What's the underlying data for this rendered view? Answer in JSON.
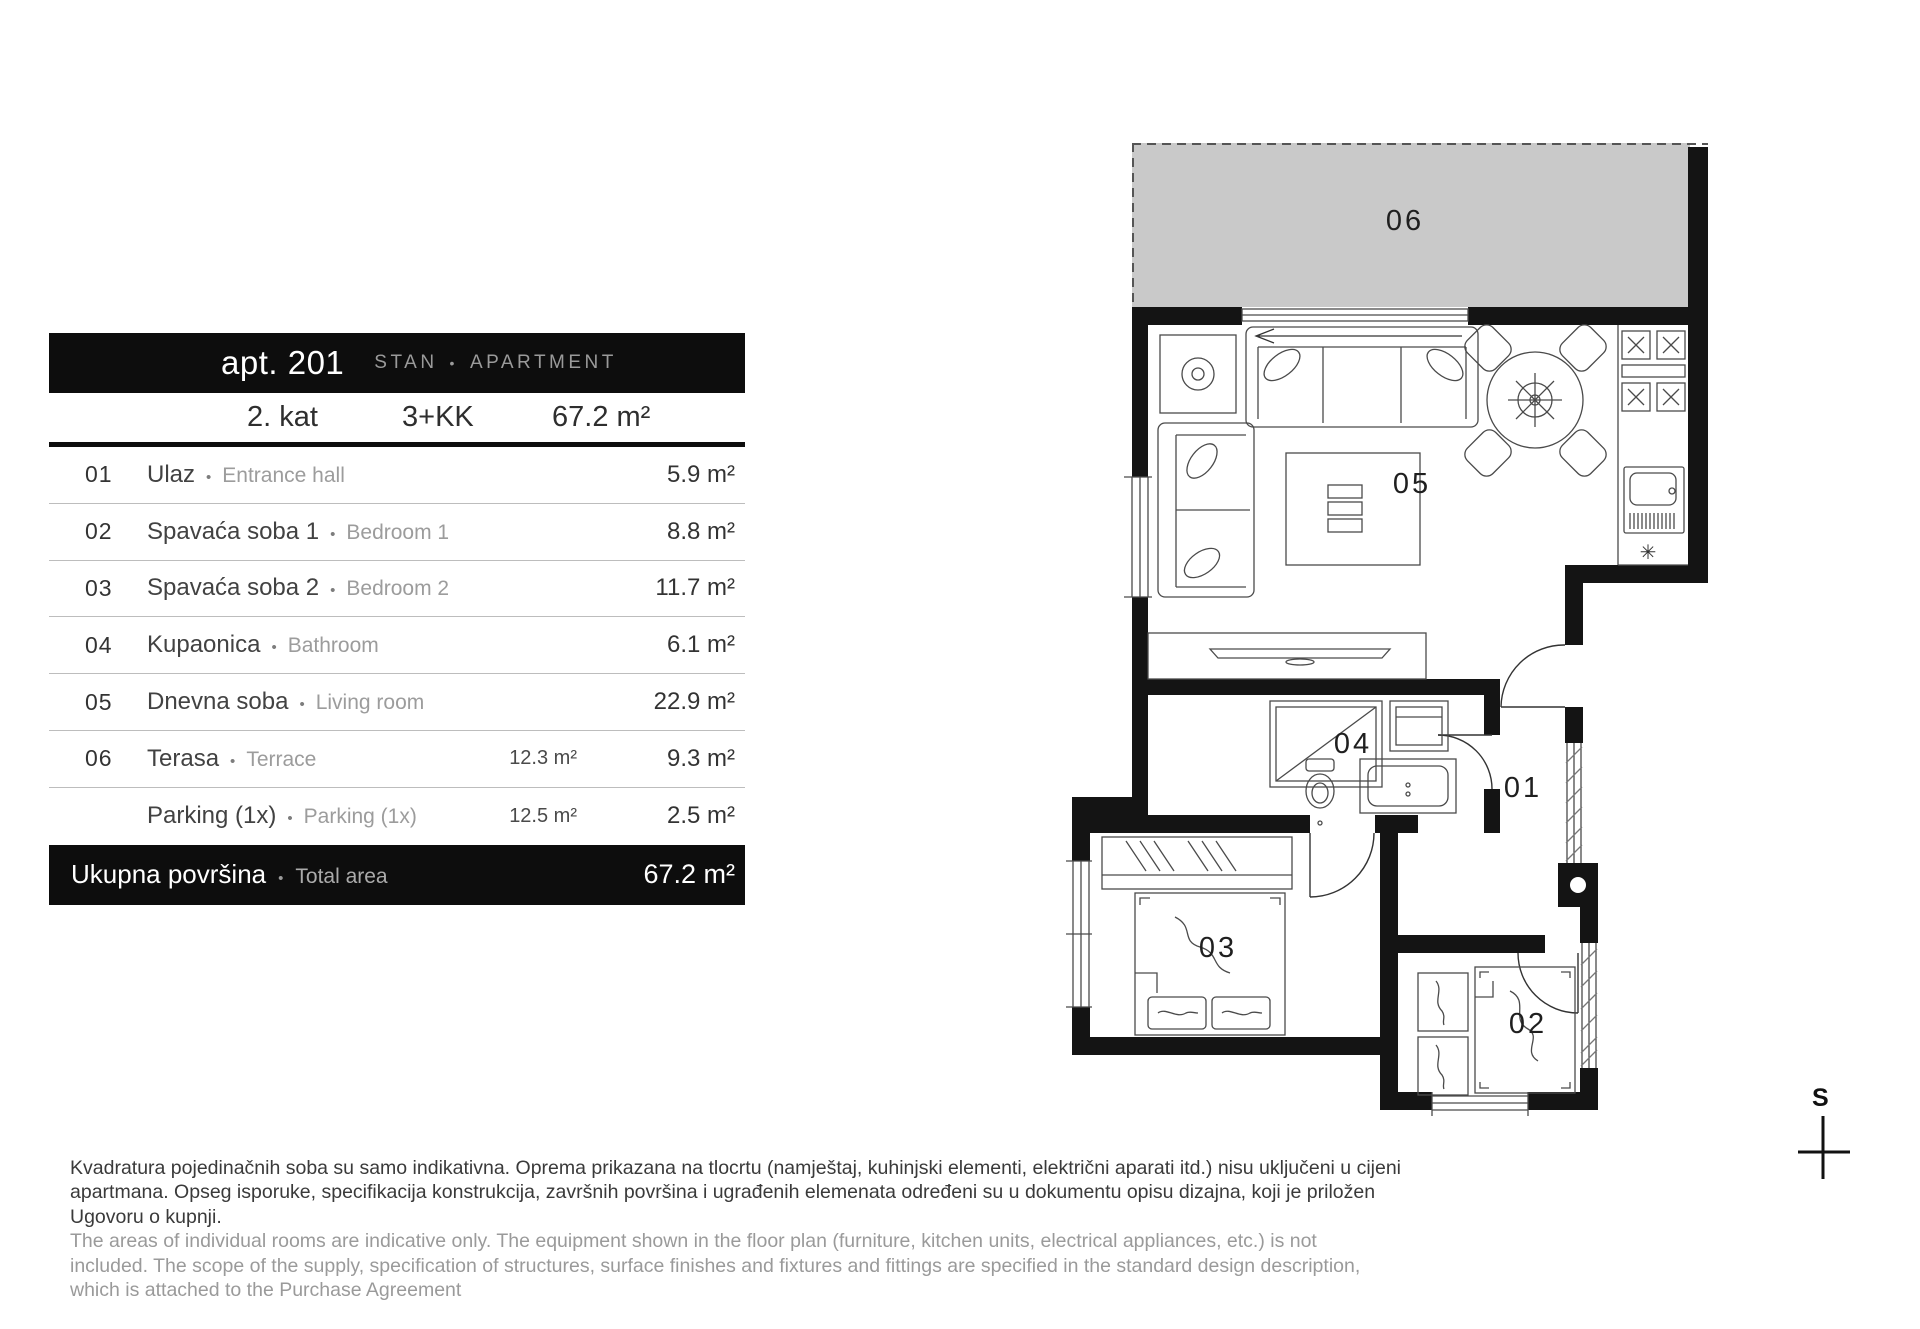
{
  "header": {
    "apt_label": "apt. 201",
    "type_hr": "STAN",
    "bullet": "•",
    "type_en": "APARTMENT",
    "floor": "2. kat",
    "layout": "3+KK",
    "total_area": "67.2 m²"
  },
  "table": {
    "rows": [
      {
        "num": "01",
        "name_hr": "Ulaz",
        "bullet": "•",
        "name_en": "Entrance hall",
        "gross": "",
        "area": "5.9 m²"
      },
      {
        "num": "02",
        "name_hr": "Spavaća soba 1",
        "bullet": "•",
        "name_en": "Bedroom 1",
        "gross": "",
        "area": "8.8 m²"
      },
      {
        "num": "03",
        "name_hr": "Spavaća soba 2",
        "bullet": "•",
        "name_en": "Bedroom 2",
        "gross": "",
        "area": "11.7 m²"
      },
      {
        "num": "04",
        "name_hr": "Kupaonica",
        "bullet": "•",
        "name_en": "Bathroom",
        "gross": "",
        "area": "6.1 m²"
      },
      {
        "num": "05",
        "name_hr": "Dnevna soba",
        "bullet": "•",
        "name_en": "Living room",
        "gross": "",
        "area": "22.9 m²"
      },
      {
        "num": "06",
        "name_hr": "Terasa",
        "bullet": "•",
        "name_en": "Terrace",
        "gross": "12.3 m²",
        "area": "9.3 m²"
      },
      {
        "num": "",
        "name_hr": "Parking (1x)",
        "bullet": "•",
        "name_en": "Parking (1x)",
        "gross": "12.5 m²",
        "area": "2.5 m²"
      }
    ],
    "total": {
      "name_hr": "Ukupna površina",
      "bullet": "•",
      "name_en": "Total area",
      "area": "67.2 m²"
    }
  },
  "plan": {
    "labels": {
      "terrace": "06",
      "living": "05",
      "bath": "04",
      "hall": "01",
      "bed3": "03",
      "bed2": "02"
    },
    "compass": "S",
    "colors": {
      "wall": "#141414",
      "terrace_fill": "#c9c9c9"
    }
  },
  "footer": {
    "hr": "Kvadratura pojedinačnih soba su samo indikativna. Oprema prikazana na tlocrtu (namještaj, kuhinjski elementi, električni aparati itd.) nisu uključeni u cijeni\napartmana. Opseg isporuke, specifikacija konstrukcija, završnih površina i ugrađenih elemenata određeni su u dokumentu opisu dizajna, koji je priložen\nUgovoru o kupnji.",
    "en": "The areas of individual rooms are indicative only. The equipment shown in the floor plan (furniture, kitchen units, electrical appliances, etc.) is not\nincluded. The scope of the supply, specification of structures, surface finishes and fixtures and fittings are specified in the standard design description,\nwhich is attached to the Purchase Agreement"
  }
}
